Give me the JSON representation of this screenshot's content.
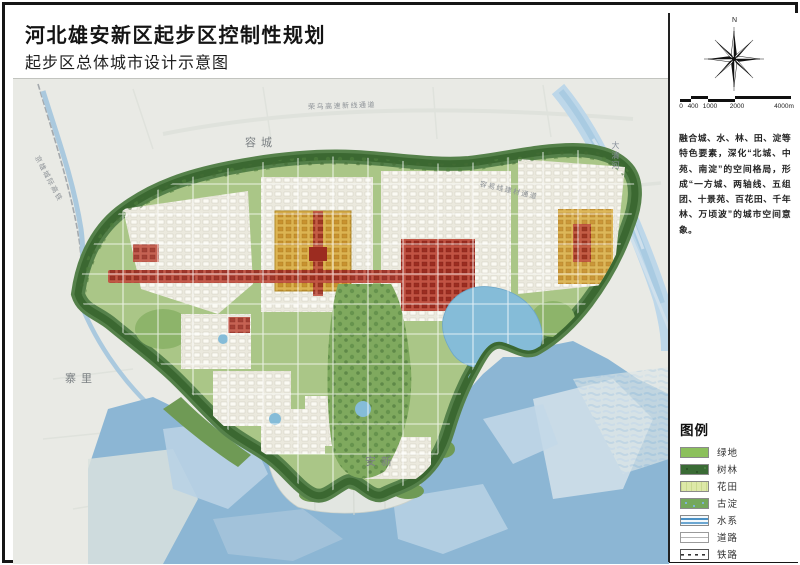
{
  "page": {
    "title": "河北雄安新区起步区控制性规划",
    "subtitle": "起步区总体城市设计示意图"
  },
  "sidebar": {
    "compass_label": "N",
    "scale": {
      "ticks": [
        "0",
        "400",
        "1000",
        "2000",
        "4000m"
      ]
    },
    "description": "融合城、水、林、田、淀等特色要素，深化“北城、中苑、南淀”的空间格局，形成“一方城、两轴线、五组团、十景苑、百花田、千年林、万顷波”的城市空间意象。",
    "legend": {
      "title": "图例",
      "items": [
        {
          "label": "绿地",
          "type": "green"
        },
        {
          "label": "树林",
          "type": "forest"
        },
        {
          "label": "花田",
          "type": "flower"
        },
        {
          "label": "古淀",
          "type": "marsh"
        },
        {
          "label": "水系",
          "type": "water"
        },
        {
          "label": "道路",
          "type": "road"
        },
        {
          "label": "铁路",
          "type": "rail"
        }
      ]
    }
  },
  "map": {
    "labels": {
      "rongcheng": "容城",
      "zhaili": "寨里",
      "anxin": "安新",
      "daqinghe": "大清河",
      "rail_nw": "京雄城际高铁",
      "expwy_north": "荣乌高速新线通道",
      "road_east": "容易线建材通道"
    }
  },
  "colors": {
    "green": "#8cc05c",
    "forest": "#3a6b35",
    "water": "#8cb6d4",
    "gold": "#d9a64a",
    "red": "#9c2c20"
  }
}
